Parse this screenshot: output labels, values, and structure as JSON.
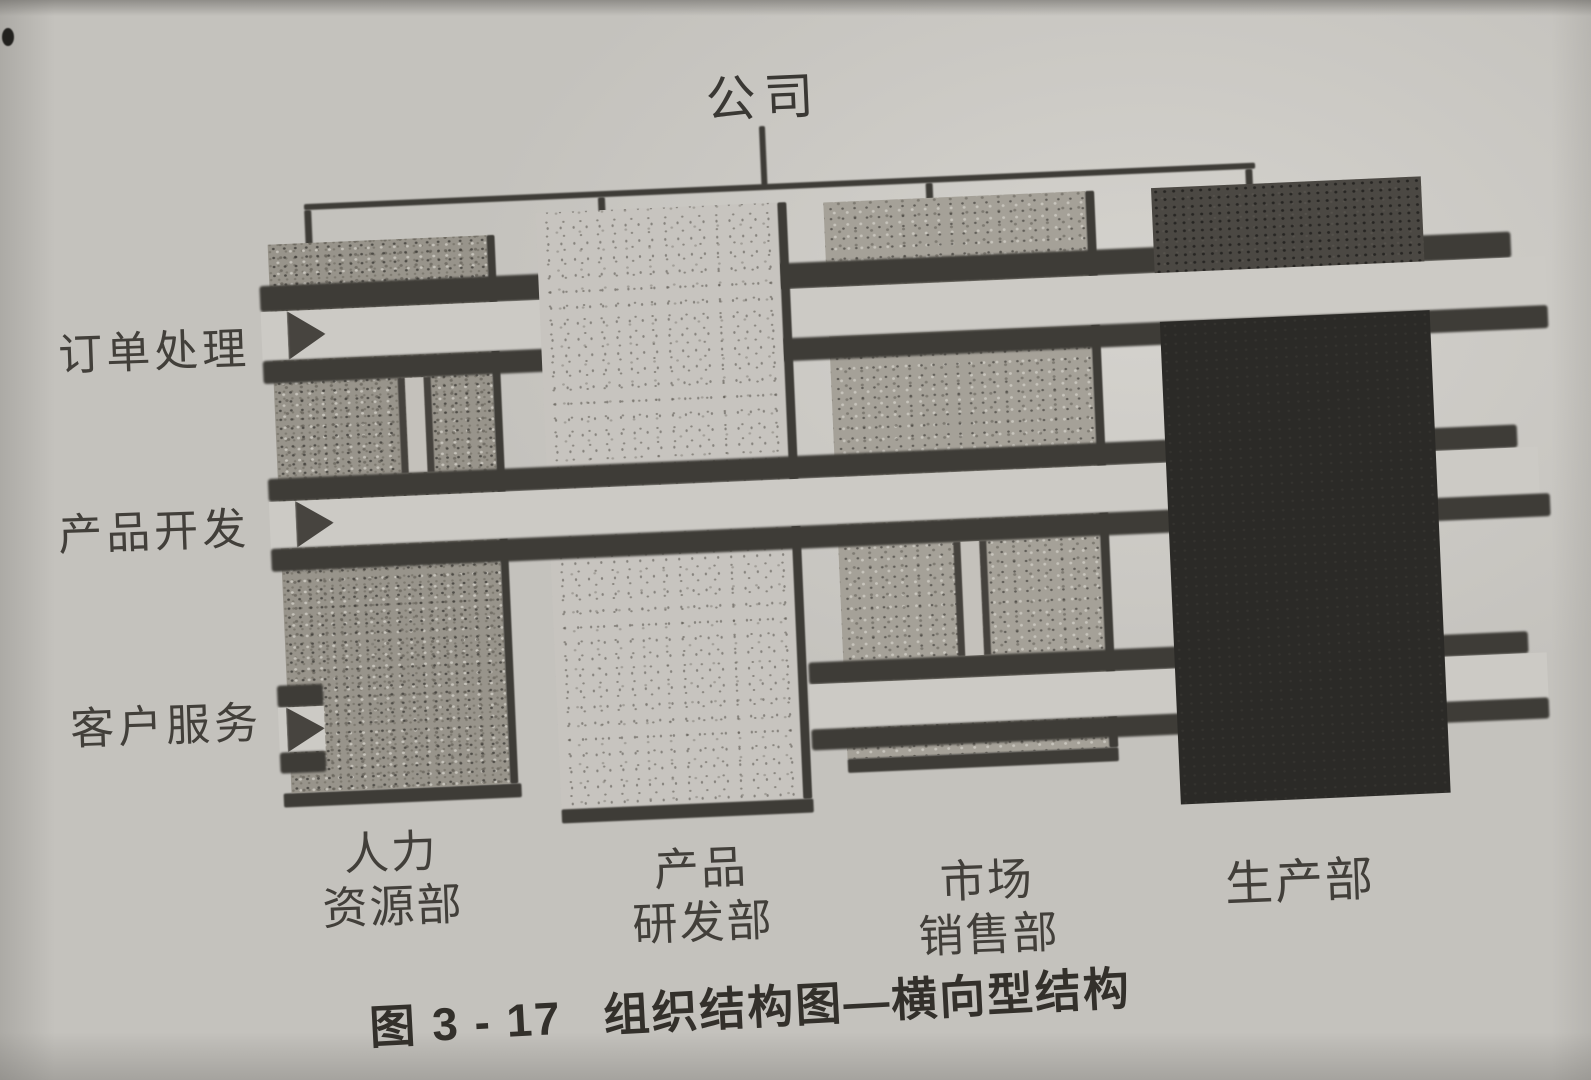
{
  "figure": {
    "root_label": "公司",
    "processes": [
      {
        "label": "订单处理"
      },
      {
        "label": "产品开发"
      },
      {
        "label": "客户服务"
      }
    ],
    "departments": [
      {
        "label": "人力资源部",
        "line1": "人力",
        "line2": "资源部",
        "shade": "medium-speckle"
      },
      {
        "label": "产品研发部",
        "line1": "产品",
        "line2": "研发部",
        "shade": "light-speckle"
      },
      {
        "label": "市场销售部",
        "line1": "市场",
        "line2": "销售部",
        "shade": "medium-speckle"
      },
      {
        "label": "生产部",
        "line1": "生产部",
        "line2": "",
        "shade": "solid-dark"
      }
    ],
    "caption_label": "图 3 - 17",
    "caption_title": "组织结构图—横向型结构",
    "colors": {
      "page_background": "#c4c2bd",
      "ink": "#3e3c37",
      "band_fill": "#cccac5",
      "column_hr": "#98948b",
      "column_rd": "#c7c4bf",
      "column_marketing": "#a5a198",
      "column_production": "#2b2a27"
    }
  }
}
